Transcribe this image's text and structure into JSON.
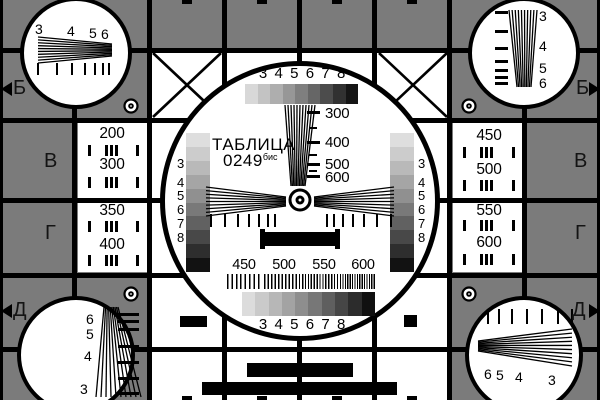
{
  "colors": {
    "background": "#7b7b7b",
    "ink": "#000000",
    "paper": "#ffffff"
  },
  "title": {
    "name": "ТАБЛИЦА",
    "number": "0249",
    "suffix": "бис"
  },
  "center": {
    "top_resolution_numbers": "3 4 5 6 7 8",
    "bottom_resolution_numbers": "3 4 5 6 7 8",
    "vertical_wedge_labels": [
      "300",
      "400",
      "500",
      "600"
    ],
    "bottom_scale_labels": [
      "450",
      "500",
      "550",
      "600"
    ],
    "left_strip_numbers": [
      "3",
      "4",
      "5",
      "6",
      "7",
      "8"
    ],
    "right_strip_numbers": [
      "3",
      "4",
      "5",
      "6",
      "7",
      "8"
    ],
    "grayscale_top": [
      "#d8d8d8",
      "#c3c3c3",
      "#aeaeae",
      "#979797",
      "#7f7f7f",
      "#666666",
      "#4c4c4c",
      "#313131",
      "#151515"
    ],
    "grayscale_left": [
      "#dedede",
      "#cccccc",
      "#b9b9b9",
      "#a5a5a5",
      "#909090",
      "#797979",
      "#616161",
      "#484848",
      "#2e2e2e",
      "#121212"
    ],
    "grayscale_right": [
      "#dedede",
      "#cccccc",
      "#b9b9b9",
      "#a5a5a5",
      "#909090",
      "#797979",
      "#616161",
      "#484848",
      "#2e2e2e",
      "#121212"
    ],
    "grayscale_bottom": [
      "#dcdcdc",
      "#cacaca",
      "#b7b7b7",
      "#a3a3a3",
      "#8e8e8e",
      "#777777",
      "#5f5f5f",
      "#464646",
      "#2c2c2c",
      "#101010"
    ]
  },
  "side_cells": {
    "left": [
      [
        "200",
        "300"
      ],
      [
        "350",
        "400"
      ]
    ],
    "right": [
      [
        "450",
        "500"
      ],
      [
        "550",
        "600"
      ]
    ]
  },
  "row_labels": {
    "left": [
      "Б",
      "В",
      "Г",
      "Д"
    ],
    "right": [
      "Б",
      "В",
      "Г",
      "Д"
    ]
  },
  "corner_numbers": {
    "top_left": [
      "3",
      "4",
      "5",
      "6"
    ],
    "top_right": [
      "3",
      "4",
      "5",
      "6"
    ],
    "bottom_left": [
      "6",
      "5",
      "4",
      "3"
    ],
    "bottom_right": [
      "6",
      "5",
      "4",
      "3"
    ]
  }
}
